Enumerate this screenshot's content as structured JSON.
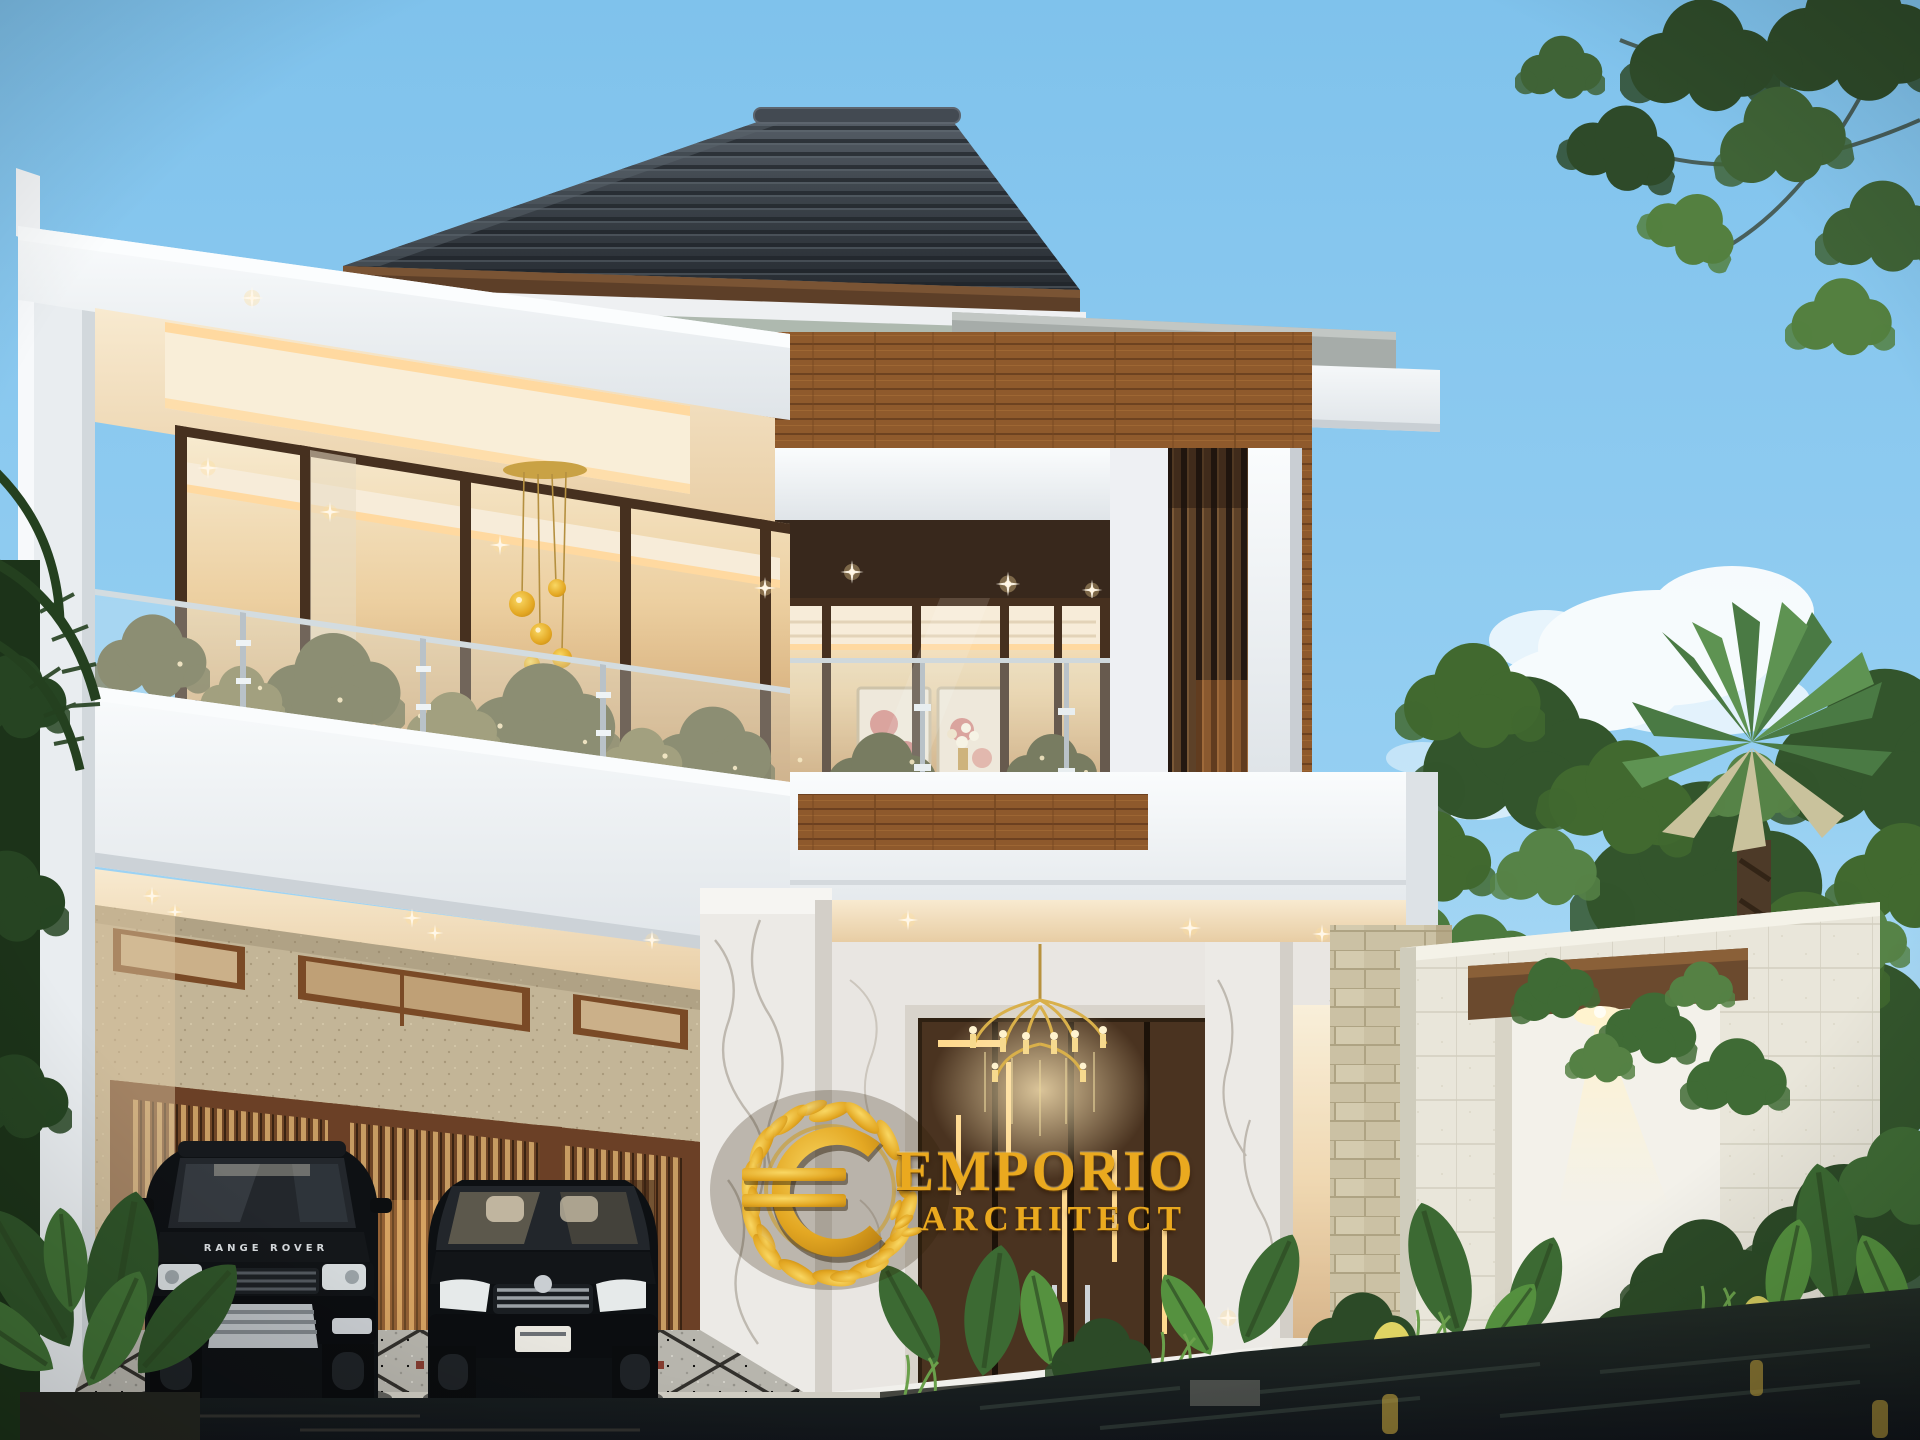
{
  "watermark": {
    "line1": "EMPORIO",
    "line2": "ARCHITECT",
    "logo_icon": "laurel-wreath-euro-icon",
    "text_color": "#EAA91F"
  },
  "vehicles": {
    "suv_badge": "RANGE ROVER"
  },
  "palette": {
    "sky": "#86C7EE",
    "roof": "#3B4249",
    "roof_fascia_wood": "#6B4A2E",
    "wall_white": "#F2F4F6",
    "wood_plank": "#9A6130",
    "slat_wood": "#5A3D26",
    "glass_warm": "#EFD4A8",
    "marble": "#EAE7E2",
    "limestone": "#D9CFB2",
    "gate_wall": "#E9E6DA",
    "foliage_dark": "#2C4A27",
    "foliage_mid": "#3F6B35",
    "foliage_light": "#5E9549",
    "water": "#171C1A",
    "accent_gold": "#EAA91F",
    "warm_light": "#FFD9A0",
    "driveway": "#B9B6AE",
    "car_black": "#0E1114"
  }
}
